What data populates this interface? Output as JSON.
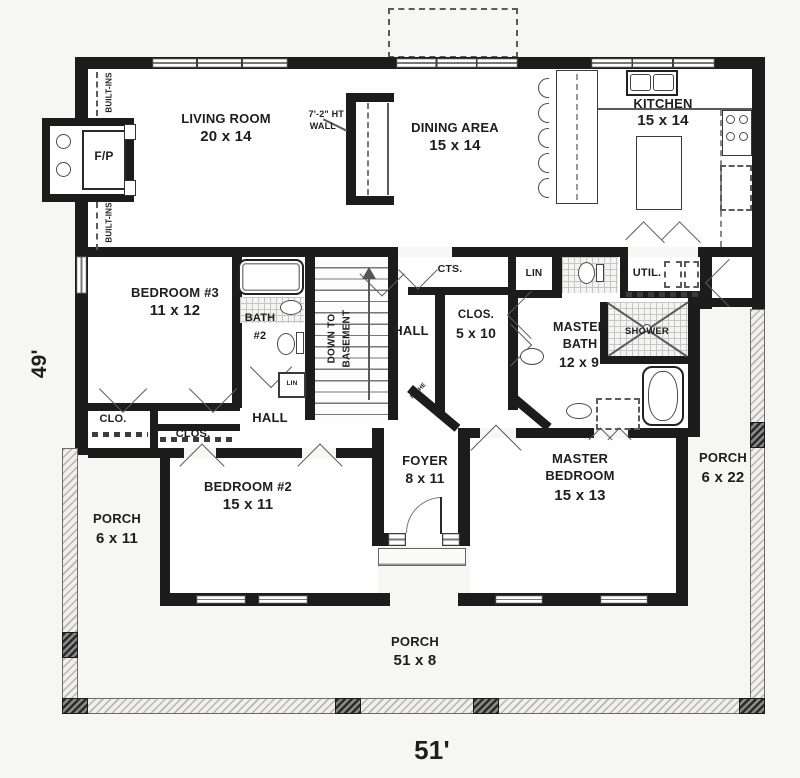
{
  "rooms": {
    "living": {
      "name": "LIVING ROOM",
      "size": "20 x 14"
    },
    "dining": {
      "name": "DINING AREA",
      "size": "15 x 14"
    },
    "kitchen": {
      "name": "KITCHEN",
      "size": "15 x 14"
    },
    "bedroom3": {
      "name": "BEDROOM #3",
      "size": "11 x 12"
    },
    "bath2": {
      "name": "BATH",
      "number": "#2"
    },
    "hall_mid": "HALL",
    "hall_lower": "HALL",
    "cts": "CTS.",
    "lin_hall": "LIN",
    "lin_bath2": "LIN",
    "closet": {
      "name": "CLOS.",
      "size": "5 x 10"
    },
    "util": "UTIL.",
    "shower": "SHOWER",
    "master_bath": {
      "name": "MASTER",
      "name2": "BATH",
      "size": "12 x 9"
    },
    "clo": "CLO.",
    "clos": "CLOS.",
    "bedroom2": {
      "name": "BEDROOM #2",
      "size": "15 x 11"
    },
    "foyer": {
      "name": "FOYER",
      "size": "8 x 11"
    },
    "master_bedroom": {
      "name": "MASTER",
      "name2": "BEDROOM",
      "size": "15 x 13"
    },
    "porch_right": {
      "name": "PORCH",
      "size": "6 x 22"
    },
    "porch_left": {
      "name": "PORCH",
      "size": "6 x 11"
    },
    "porch_front": {
      "name": "PORCH",
      "size": "51 x 8"
    }
  },
  "annotations": {
    "fireplace": "F/P",
    "built_ins": "BUILT-INS",
    "ht_wall": {
      "line1": "7'-2\" HT",
      "line2": "WALL"
    },
    "stairs": {
      "line1": "DOWN TO",
      "line2": "BASEMENT"
    },
    "niche": "NICHE",
    "shower_dim": "3'2\""
  },
  "dimensions": {
    "width": "51'",
    "height": "49'"
  },
  "colors": {
    "wall": "#1c1c1c",
    "background": "#f6f6f5",
    "floor": "#fefefe"
  }
}
